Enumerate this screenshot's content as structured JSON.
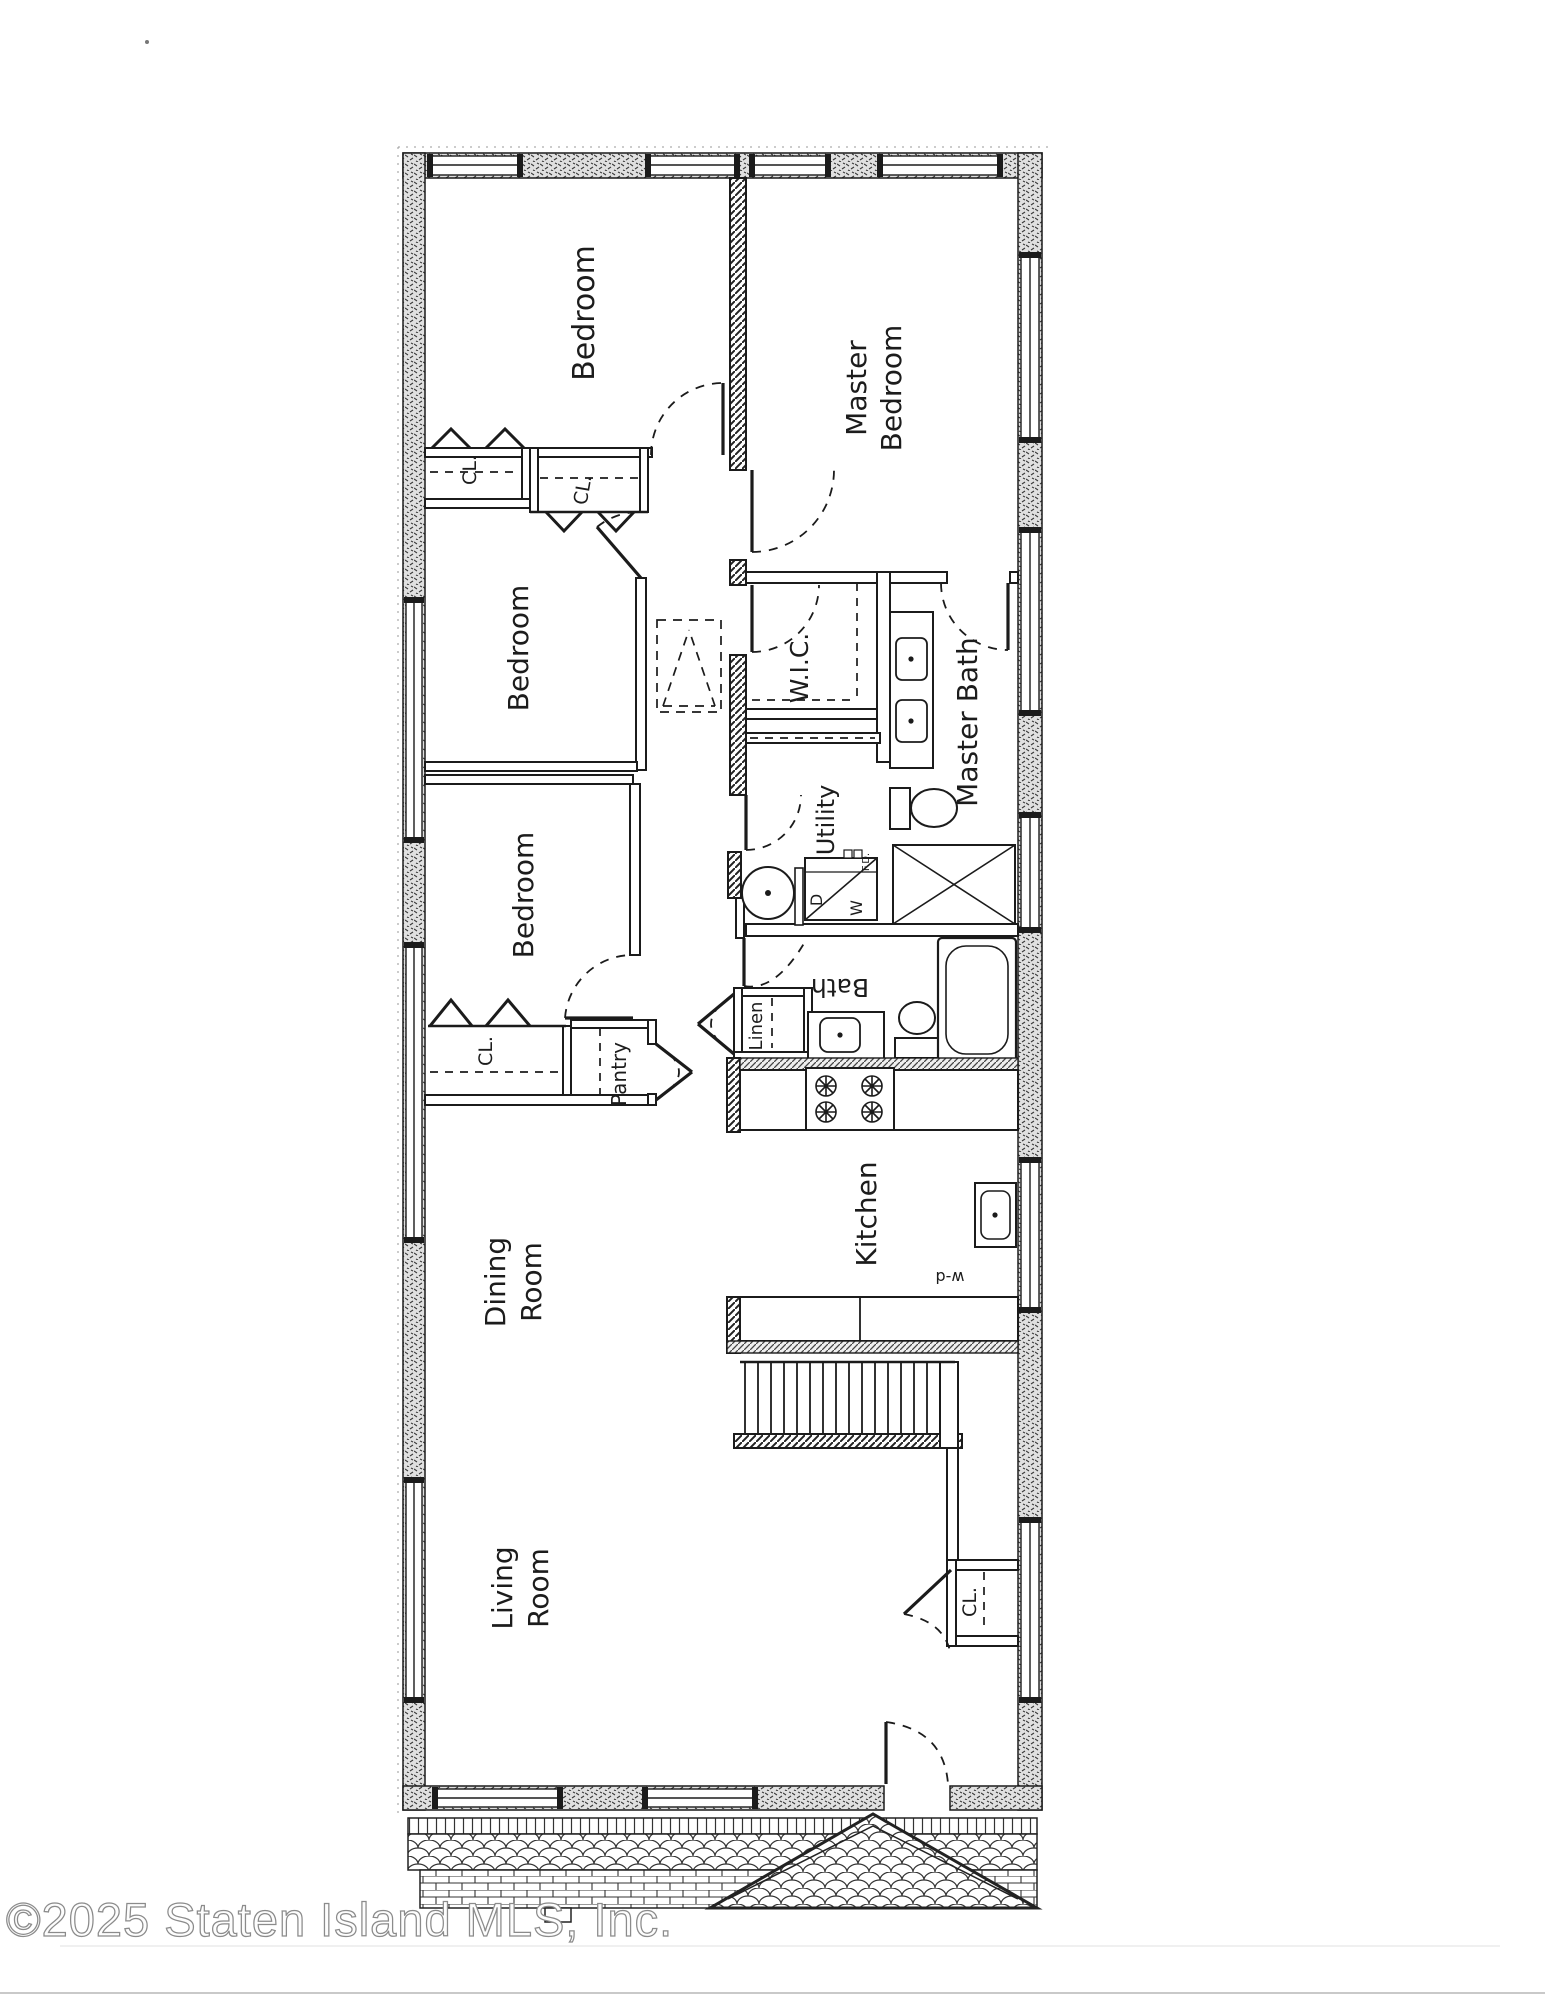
{
  "plan": {
    "rooms": {
      "bedroom_top": "Bedroom",
      "master_line1": "Master",
      "master_line2": "Bedroom",
      "bedroom_middle": "Bedroom",
      "bedroom_lower": "Bedroom",
      "wic": "W.I.C.",
      "master_bath": "Master Bath",
      "utility": "Utility",
      "bath": "Bath",
      "kitchen": "Kitchen",
      "dining_line1": "Dining",
      "dining_line2": "Room",
      "living_line1": "Living",
      "living_line2": "Room"
    },
    "closets": {
      "cl_bedroom_top": "CL.",
      "cl_hall": "CL.",
      "cl_bedroom_lower": "CL.",
      "cl_entry": "CL.",
      "linen": "Linen",
      "pantry": "Pantry"
    },
    "appliances": {
      "washer": "W",
      "dryer": "D",
      "floor_drain": "F.D.",
      "dishwasher": "w-d"
    }
  },
  "footer": {
    "copyright": "©2025 Staten Island MLS, Inc."
  }
}
